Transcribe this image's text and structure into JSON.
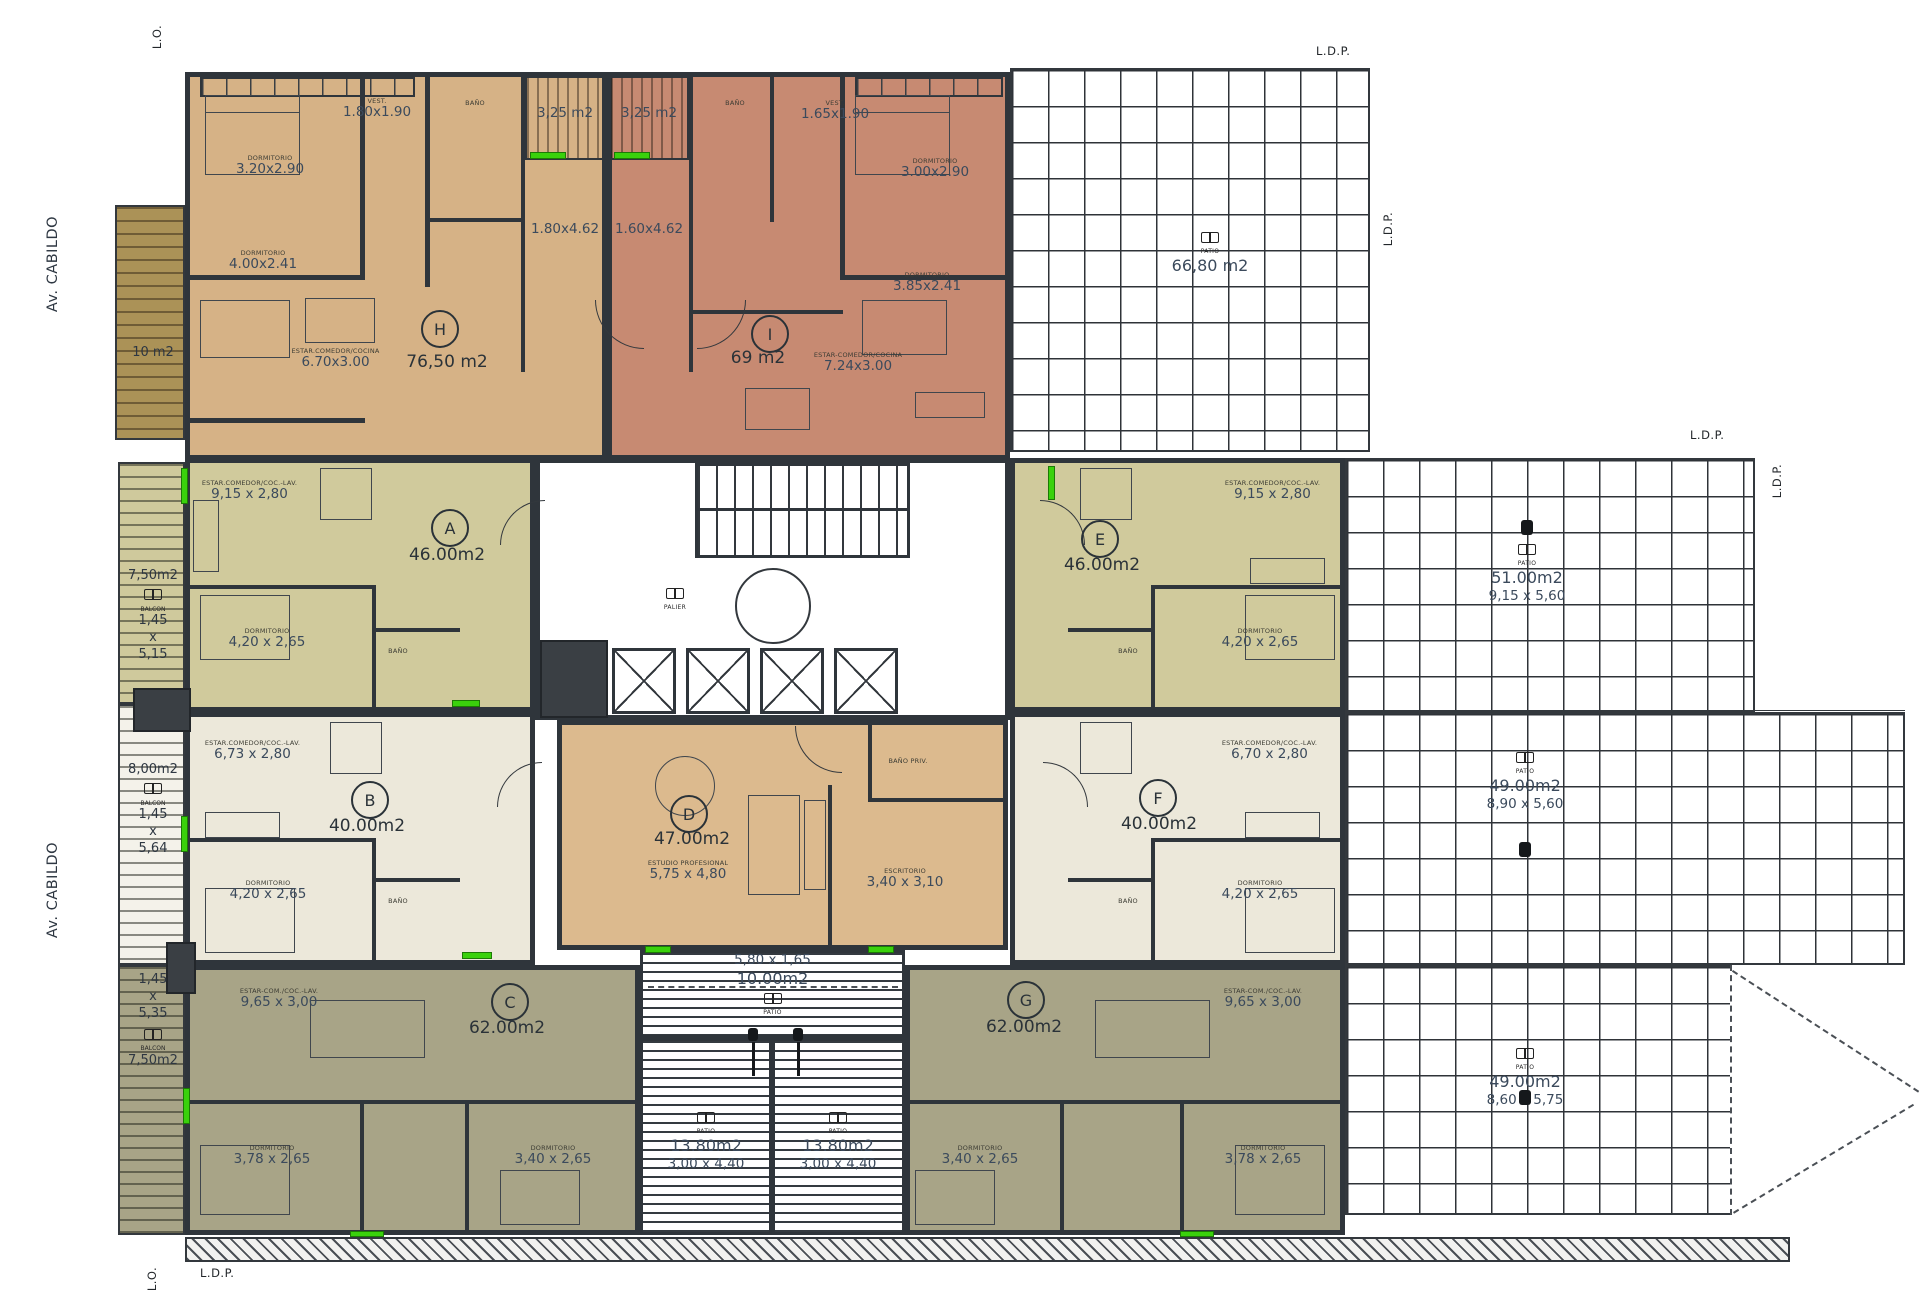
{
  "boundary": {
    "lo_top": "L.O.",
    "lo_bottom": "L.O.",
    "ldp_topright": "L.D.P.",
    "ldp_right_upper_v": "L.D.P.",
    "ldp_mid_h": "L.D.P.",
    "ldp_mid_v": "L.D.P.",
    "ldp_right_lower": "L.D.P.",
    "ldp_bottomleft": "L.D.P.",
    "street1": "Av. CABILDO",
    "street2": "Av. CABILDO"
  },
  "units": {
    "h": {
      "letter": "H",
      "area": "76,50 m2",
      "bath": "BAÑO",
      "rooms": {
        "dorm1": {
          "t": "DORMITORIO",
          "d": "3.20x2.90"
        },
        "dorm2": {
          "t": "DORMITORIO",
          "d": "4.00x2.41"
        },
        "vest": {
          "t": "VEST.",
          "d": "1.80x1.90"
        },
        "living": {
          "t": "ESTAR.COMEDOR/COCINA",
          "d": "6.70x3.00"
        }
      }
    },
    "i": {
      "letter": "I",
      "area": "69 m2",
      "bath": "BAÑO",
      "rooms": {
        "vest": {
          "t": "VEST.",
          "d": "1.65x1.90"
        },
        "dorm1": {
          "t": "DORMITORIO",
          "d": "3.00x2.90"
        },
        "dorm2": {
          "t": "DORMITORIO",
          "d": "3.85x2.41"
        },
        "living": {
          "t": "ESTAR-COMEDOR/COCINA",
          "d": "7.24x3.00"
        }
      }
    },
    "a": {
      "letter": "A",
      "area": "46.00m2",
      "bath": "BAÑO",
      "rooms": {
        "living": {
          "t": "ESTAR.COMEDOR/COC.-LAV.",
          "d": "9,15 x 2,80"
        },
        "dorm": {
          "t": "DORMITORIO",
          "d": "4,20 x 2,65"
        }
      }
    },
    "b": {
      "letter": "B",
      "area": "40.00m2",
      "bath": "BAÑO",
      "rooms": {
        "living": {
          "t": "ESTAR.COMEDOR/COC.-LAV.",
          "d": "6,73 x 2,80"
        },
        "dorm": {
          "t": "DORMITORIO",
          "d": "4,20 x 2,65"
        }
      }
    },
    "c": {
      "letter": "C",
      "area": "62.00m2",
      "rooms": {
        "living": {
          "t": "ESTAR-COM./COC.-LAV.",
          "d": "9,65 x 3,00"
        },
        "dorm1": {
          "t": "DORMITORIO",
          "d": "3,78 x 2,65"
        },
        "dorm2": {
          "t": "DORMITORIO",
          "d": "3,40 x 2,65"
        }
      }
    },
    "d": {
      "letter": "D",
      "area": "47.00m2",
      "bath": "BAÑO PRIV.",
      "rooms": {
        "studio": {
          "t": "ESTUDIO PROFESIONAL",
          "d": "5,75 x 4,80"
        },
        "office": {
          "t": "ESCRITORIO",
          "d": "3,40 x 3,10"
        }
      }
    },
    "e": {
      "letter": "E",
      "area": "46.00m2",
      "bath": "BAÑO",
      "rooms": {
        "living": {
          "t": "ESTAR.COMEDOR/COC.-LAV.",
          "d": "9,15 x 2,80"
        },
        "dorm": {
          "t": "DORMITORIO",
          "d": "4,20 x 2,65"
        }
      }
    },
    "f": {
      "letter": "F",
      "area": "40.00m2",
      "bath": "BAÑO",
      "rooms": {
        "living": {
          "t": "ESTAR.COMEDOR/COC.-LAV.",
          "d": "6,70 x 2,80"
        },
        "dorm": {
          "t": "DORMITORIO",
          "d": "4,20 x 2,65"
        }
      }
    },
    "g": {
      "letter": "G",
      "area": "62.00m2",
      "rooms": {
        "living": {
          "t": "ESTAR-COM./COC.-LAV.",
          "d": "9,65 x 3,00"
        },
        "dorm1": {
          "t": "DORMITORIO",
          "d": "3,40 x 2,65"
        },
        "dorm2": {
          "t": "DORMITORIO",
          "d": "3,78 x 2,65"
        }
      }
    }
  },
  "patios": {
    "top_right": {
      "t": "PATIO",
      "area": "66,80 m2"
    },
    "right_upper": {
      "t": "PATIO",
      "area": "51.00m2",
      "d": "9,15 x 5,60"
    },
    "right_middle": {
      "t": "PATIO",
      "area": "49.00m2",
      "d": "8,90 x 5,60"
    },
    "right_lower": {
      "t": "PATIO",
      "area": "49.00m2",
      "d": "8,60 x 5,75"
    },
    "center_strip": {
      "t": "PATIO",
      "area": "10.00m2",
      "d": "5,80 x 1,65"
    },
    "center_left": {
      "t": "PATIO",
      "area": "13.80m2",
      "d": "3,00 x 4,40"
    },
    "center_right": {
      "t": "PATIO",
      "area": "13.80m2",
      "d": "3,00 x 4,40"
    },
    "balc_h": {
      "area": "3,25 m2"
    },
    "balc_i": {
      "area": "3,25 m2"
    },
    "corr_h": {
      "d": "1.80x4.62"
    },
    "corr_i": {
      "d": "1.60x4.62"
    }
  },
  "balconies": {
    "top": {
      "area": "10 m2"
    },
    "a": {
      "area": "7,50m2",
      "t": "BALCON",
      "d1": "1,45",
      "d2": "x",
      "d3": "5,15"
    },
    "b": {
      "area": "8,00m2",
      "t": "BALCON",
      "d1": "1,45",
      "d2": "x",
      "d3": "5,64"
    },
    "c": {
      "area": "7,50m2",
      "t": "BALCON",
      "d1": "1,45",
      "d2": "x",
      "d3": "5,35"
    }
  },
  "core": {
    "palier": "PALIER"
  },
  "colors": {
    "unit_h": "#d6b286",
    "unit_i": "#c78a72",
    "unit_a_e": "#d0ca9c",
    "unit_b_f": "#ece8da",
    "unit_c_g": "#a8a487",
    "unit_d": "#dcba8e",
    "wall": "#2f353b",
    "accent_green": "#3ad10c",
    "dim_text": "#3b4a5c"
  }
}
